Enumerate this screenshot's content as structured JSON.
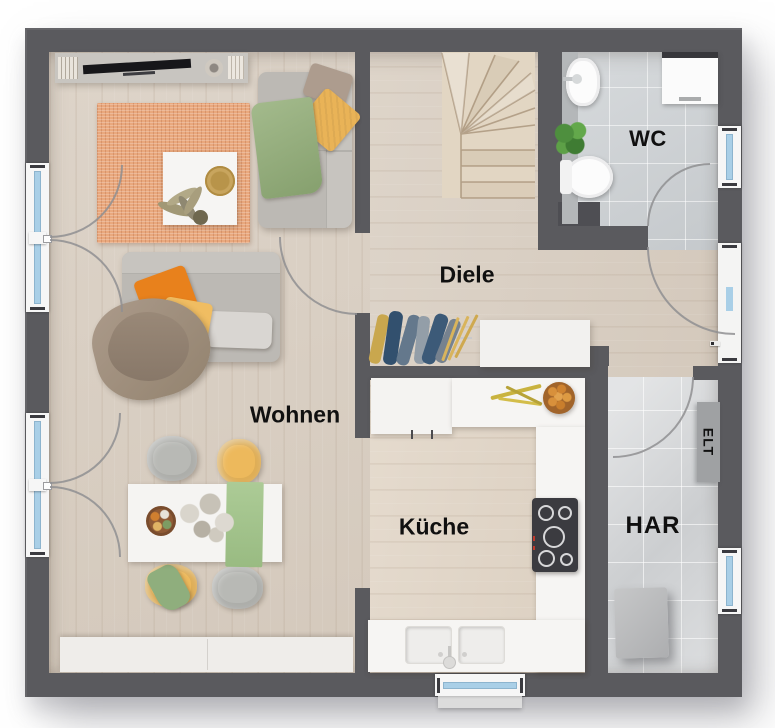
{
  "rooms": {
    "wohnen": {
      "label": "Wohnen"
    },
    "diele": {
      "label": "Diele"
    },
    "wc": {
      "label": "WC"
    },
    "kueche": {
      "label": "Küche"
    },
    "har": {
      "label": "HAR"
    },
    "elt": {
      "label": "ELT"
    }
  },
  "colors": {
    "wall": "#5a5a5e",
    "wood": "#dbd1c5",
    "wood_kitchen": "#e3d8ca",
    "tile": "#ced2d5",
    "tile_har": "#d4d6d8",
    "stair_wood": "#e2d6c3",
    "rug": "#e9a87d",
    "glass": "#a9cfe7",
    "frame": "#f6f6f6",
    "counter": "#f6f5f3",
    "sofa": "#bcb9b4",
    "sofa_light": "#c7c4bf",
    "pillow_orange": "#e8811c",
    "pillow_yellow": "#e9b357",
    "chair_yellow": "#edb95c",
    "chair_gray": "#b8b9b5",
    "green_textile": "#9ab184",
    "green_runner": "#accb96",
    "taupe": "#a39282",
    "cabinet_white": "#f2f1ef",
    "appliance_gray": "#babbbc",
    "arc": "#8f8f92",
    "label_text": "#101010"
  }
}
